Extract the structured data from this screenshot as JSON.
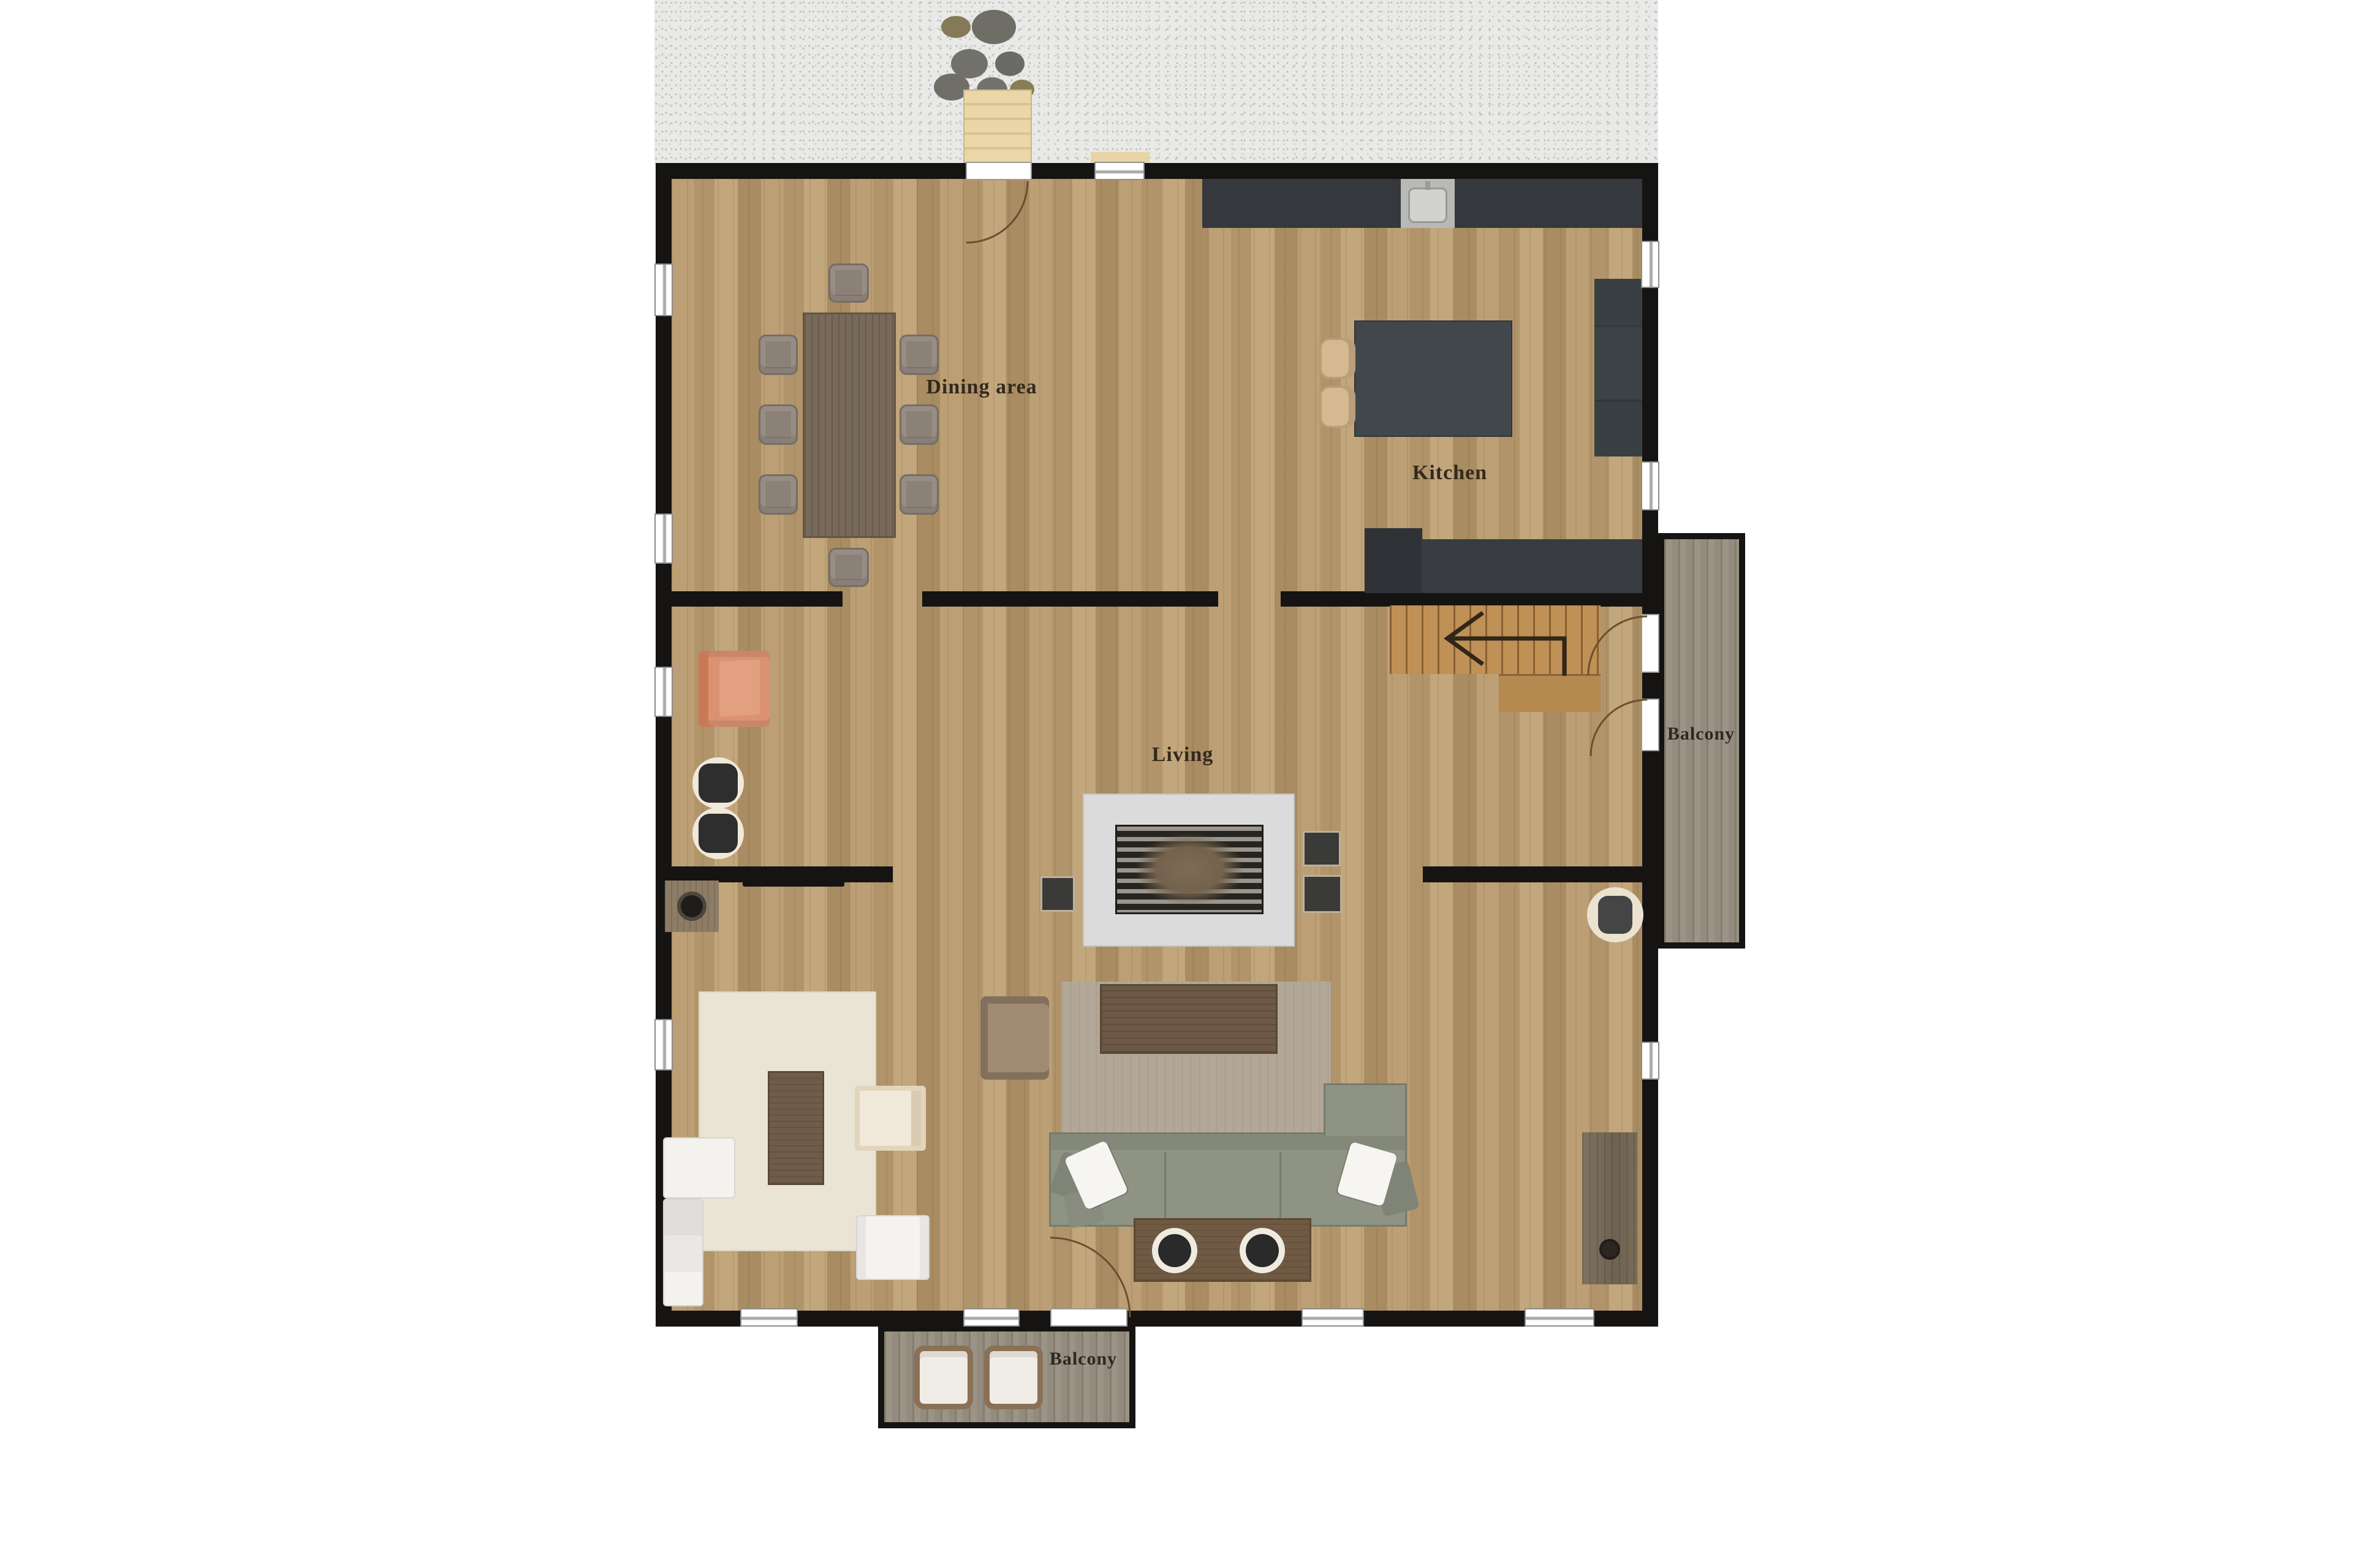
{
  "plan_title": "First floor plan",
  "labels": {
    "dining": "Dining area",
    "kitchen": "Kitchen",
    "living": "Living",
    "balcony_right": "Balcony",
    "balcony_bottom": "Balcony"
  },
  "colors": {
    "background": "#ffffff",
    "wall": "#161412",
    "floor_wood": "#b5986e",
    "gravel": "#e9e9e7",
    "counter_dark": "#35393d",
    "island": "#42474c",
    "stairs": "#c09156",
    "deck_plank": "#938b7d",
    "sofa_green": "#8e9383",
    "rug_living": "#b3a898",
    "rug_tv": "#eae4d4",
    "armchair_orange": "#db9272",
    "fireplace_surround": "#dbdbdb",
    "label_text": "#33291d",
    "doormat": "#e8d4a6"
  },
  "inventory": {
    "dining_chairs": 8,
    "dining_tables": 1,
    "kitchen_island_stools": 2,
    "kitchen_sinks": 1,
    "fireplaces": 1,
    "green_sofas": 1,
    "white_sofas": 1,
    "armchairs": 3,
    "coffee_tables": 3,
    "media_consoles": 1,
    "balconies": 2,
    "balcony_chairs": 2,
    "stepping_stones": 7,
    "staircases": 1
  }
}
